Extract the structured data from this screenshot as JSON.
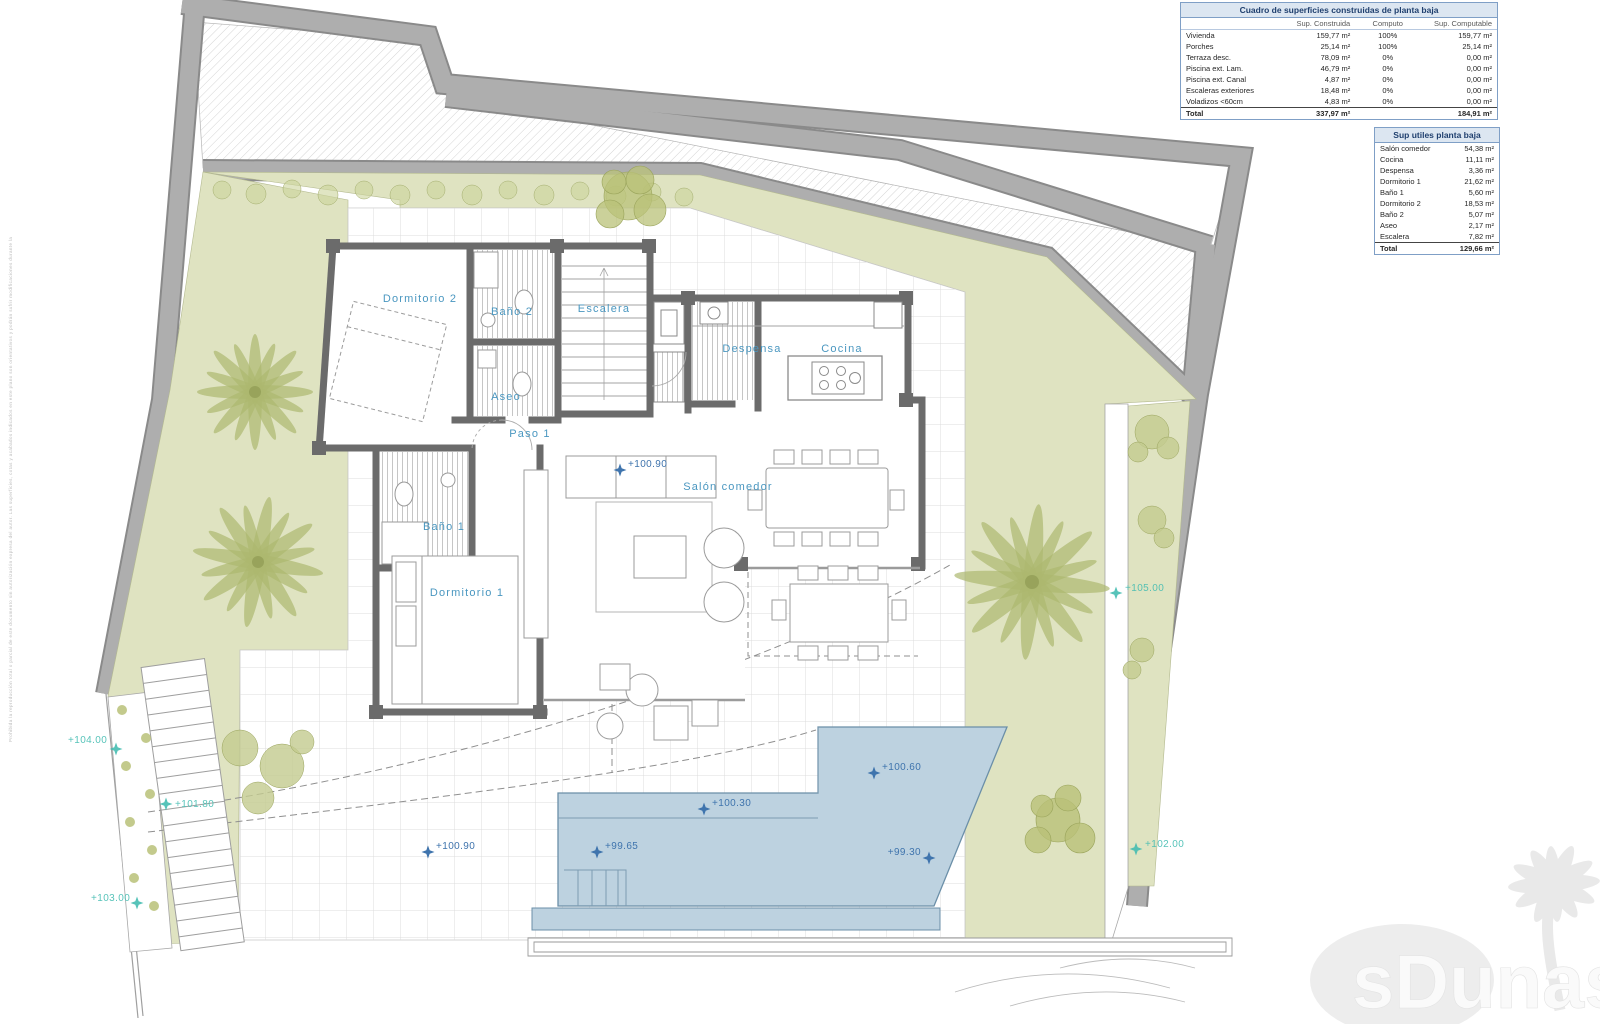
{
  "plan": {
    "rooms": {
      "dormitorio2": "Dormitorio 2",
      "bano2": "Baño 2",
      "escalera": "Escalera",
      "aseo": "Aseo",
      "paso1": "Paso 1",
      "despensa": "Despensa",
      "cocina": "Cocina",
      "salon": "Salón comedor",
      "bano1": "Baño 1",
      "dormitorio1": "Dormitorio 1"
    },
    "levels_blue": {
      "l10090a": "+100.90",
      "l10090b": "+100.90",
      "l9965": "+99.65",
      "l10030": "+100.30",
      "l10060": "+100.60",
      "l9930": "+99.30"
    },
    "levels_teal": {
      "l10400": "+104.00",
      "l10180": "+101.80",
      "l10300": "+103.00",
      "l10200": "+102.00",
      "l10500": "+105.00"
    }
  },
  "tables": {
    "construidas": {
      "title": "Cuadro de superficies construidas de planta baja",
      "cols": [
        "",
        "Sup. Construida",
        "Computo",
        "Sup. Computable"
      ],
      "rows": [
        [
          "Vivienda",
          "159,77 m²",
          "100%",
          "159,77 m²"
        ],
        [
          "Porches",
          "25,14 m²",
          "100%",
          "25,14 m²"
        ],
        [
          "Terraza desc.",
          "78,09 m²",
          "0%",
          "0,00 m²"
        ],
        [
          "Piscina ext. Lam.",
          "46,79 m²",
          "0%",
          "0,00 m²"
        ],
        [
          "Piscina ext. Canal",
          "4,87 m²",
          "0%",
          "0,00 m²"
        ],
        [
          "Escaleras exteriores",
          "18,48 m²",
          "0%",
          "0,00 m²"
        ],
        [
          "Voladizos <60cm",
          "4,83 m²",
          "0%",
          "0,00 m²"
        ]
      ],
      "total": [
        "Total",
        "337,97 m²",
        "",
        "184,91 m²"
      ]
    },
    "utiles": {
      "title": "Sup utiles planta baja",
      "rows": [
        [
          "Salón comedor",
          "54,38 m²"
        ],
        [
          "Cocina",
          "11,11 m²"
        ],
        [
          "Despensa",
          "3,36 m²"
        ],
        [
          "Dormitorio 1",
          "21,62 m²"
        ],
        [
          "Baño 1",
          "5,60 m²"
        ],
        [
          "Dormitorio 2",
          "18,53 m²"
        ],
        [
          "Baño 2",
          "5,07 m²"
        ],
        [
          "Aseo",
          "2,17 m²"
        ],
        [
          "Escalera",
          "7,82 m²"
        ]
      ],
      "total": [
        "Total",
        "129,66 m²"
      ]
    }
  },
  "watermark": {
    "text": "sDunas"
  },
  "disclaimer": "Prohibida la reproducción total o parcial de este documento sin autorización expresa del autor. Las superficies, cotas y acabados indicados en este plano son orientativos y podrán sufrir modificaciones durante la ejecución de la obra por exigencias técnicas o legales.",
  "colors": {
    "accent_blue": "#4a97c0",
    "marker_blue": "#3f74ad",
    "marker_teal": "#45bdb2",
    "garden_green": "#dfe3c1",
    "pool_blue": "#bdd2e0",
    "boundary_gray": "#a8a8a8",
    "table_header_bg": "#dce6f1",
    "table_border": "#7f9fc6"
  }
}
